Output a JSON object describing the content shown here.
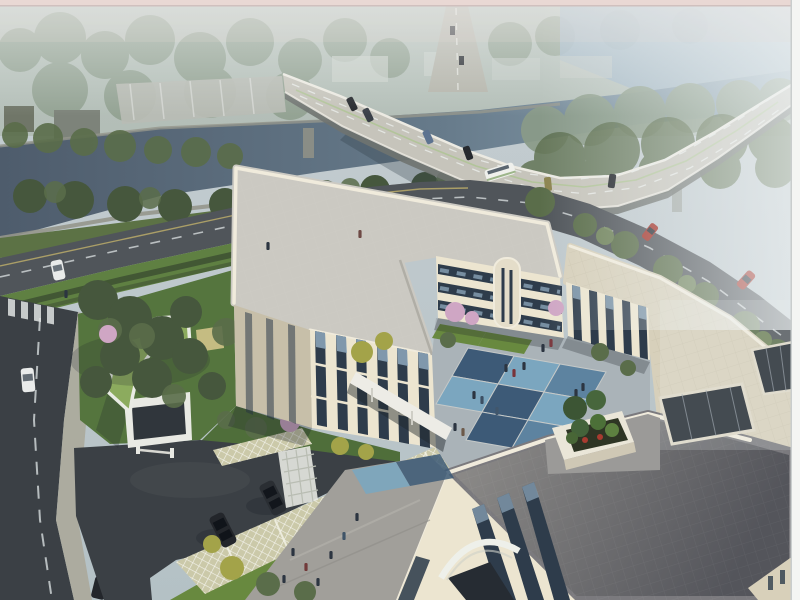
{
  "scene": {
    "title": "Aerial architectural rendering",
    "subject": "Three-storey cream courtyard building with a blue checkerboard courtyard, beside a canal crossed by a curved highway bridge, with landscaped entrance, green-roof gatehouse and grass-paver parking",
    "atmosphere": "hazy dusk light, fog increasing toward upper right",
    "frame": {
      "top_strip": true,
      "right_strip": true
    }
  },
  "objects": {
    "bridge": {
      "label": "curved highway bridge over canal",
      "cars": 6,
      "buses": 1,
      "piers": 3
    },
    "river": {
      "label": "canal with stone embankments and tree rows"
    },
    "distant": {
      "warehouse_buildings": 3,
      "hazy_box_buildings": 4,
      "vertical_road_cars": 2
    },
    "riverside_road": {
      "red_cars": 2,
      "dark_cars": 1,
      "white_parked_cars": 1,
      "lane_markings": "dashed white"
    },
    "west_road": {
      "white_cars": 1,
      "dark_cars": 1,
      "crosswalk": true,
      "lane_markings": "dashed white"
    },
    "entrance": {
      "gatehouse": "curved green-roof gate building",
      "barrier": true,
      "trellis": true
    },
    "parking": {
      "type": "grass-paver stalls",
      "stall_dividers": 5,
      "dark_suvs": 2
    },
    "building": {
      "wings": [
        "west",
        "north",
        "east",
        "front"
      ],
      "storeys": 3,
      "courtyard_tiles": [
        "light-blue",
        "dark-blue"
      ],
      "roof_terrace_planter": true,
      "roof_atriums": 2,
      "entrance_arch": true,
      "connecting_canopy": true
    },
    "people": {
      "courtyard": 12,
      "south_plaza": 7,
      "garden": 3
    }
  },
  "colors": {
    "pinkStrip": "#e9d8d4",
    "frameWhite": "#f4f5f3",
    "skyTop": "#c6ced2",
    "skyBot": "#b6c2c6",
    "hazeWhite": "#eef2f3",
    "waterDeep": "#4e5c6c",
    "waterLight": "#8fa5b2",
    "waterFar": "#9db3c2",
    "bankStone": "#95968c",
    "bridgeDeck": "#c6c4bb",
    "bridgeEdge": "#eceae2",
    "bridgeSide": "#6f7370",
    "laneWhite": "#e8ebe8",
    "laneGreen": "#a9c48b",
    "roadDark": "#3b4045",
    "roadMid": "#50555a",
    "roadLine": "#ccd2d4",
    "roadYellow": "#c0b06a",
    "sidewalk": "#aba89a",
    "grassBelt": "#5f8042",
    "lawn": "#68893f",
    "gardenDark": "#55753e",
    "hedge": "#3f5233",
    "treeDark": "#46573d",
    "treeMid": "#5a6d4a",
    "treeLight": "#72875a",
    "treeYellow": "#a3a349",
    "treeHaze": "#8a9b88",
    "blossom": "#cfa6c4",
    "greenRoof": "#8cab5e",
    "whiteStruct": "#e8e9e3",
    "cream": "#ece5d0",
    "creamShade": "#d8d0ba",
    "creamDark": "#c7bfa9",
    "parapet": "#f0ebdc",
    "roofLight": "#cbc9c2",
    "roofTan": "#d7d0bb",
    "roofGrayA": "#8f8d8c",
    "roofGrayB": "#55565c",
    "winDark": "#2e3c4b",
    "winGlass": "#8fa9bd",
    "atriumDark": "#1f262e",
    "courtBase": "#aab3b8",
    "tileLight": "#7ba6bf",
    "tileMid": "#5d83a0",
    "tileDark": "#3d5a77",
    "plaza": "#a19f9a",
    "lattice": "#cbc9a9",
    "figure": "#2c3541",
    "carDark": "#26292e",
    "carRed": "#a23228",
    "carWhite": "#e9ebea",
    "busWhite": "#eff0ec",
    "shrubGreen": "#44633a",
    "shrubRed": "#a83b30",
    "soil": "#2e3524",
    "terracePad": "#9b9a98",
    "glassBand": "#46525c"
  }
}
